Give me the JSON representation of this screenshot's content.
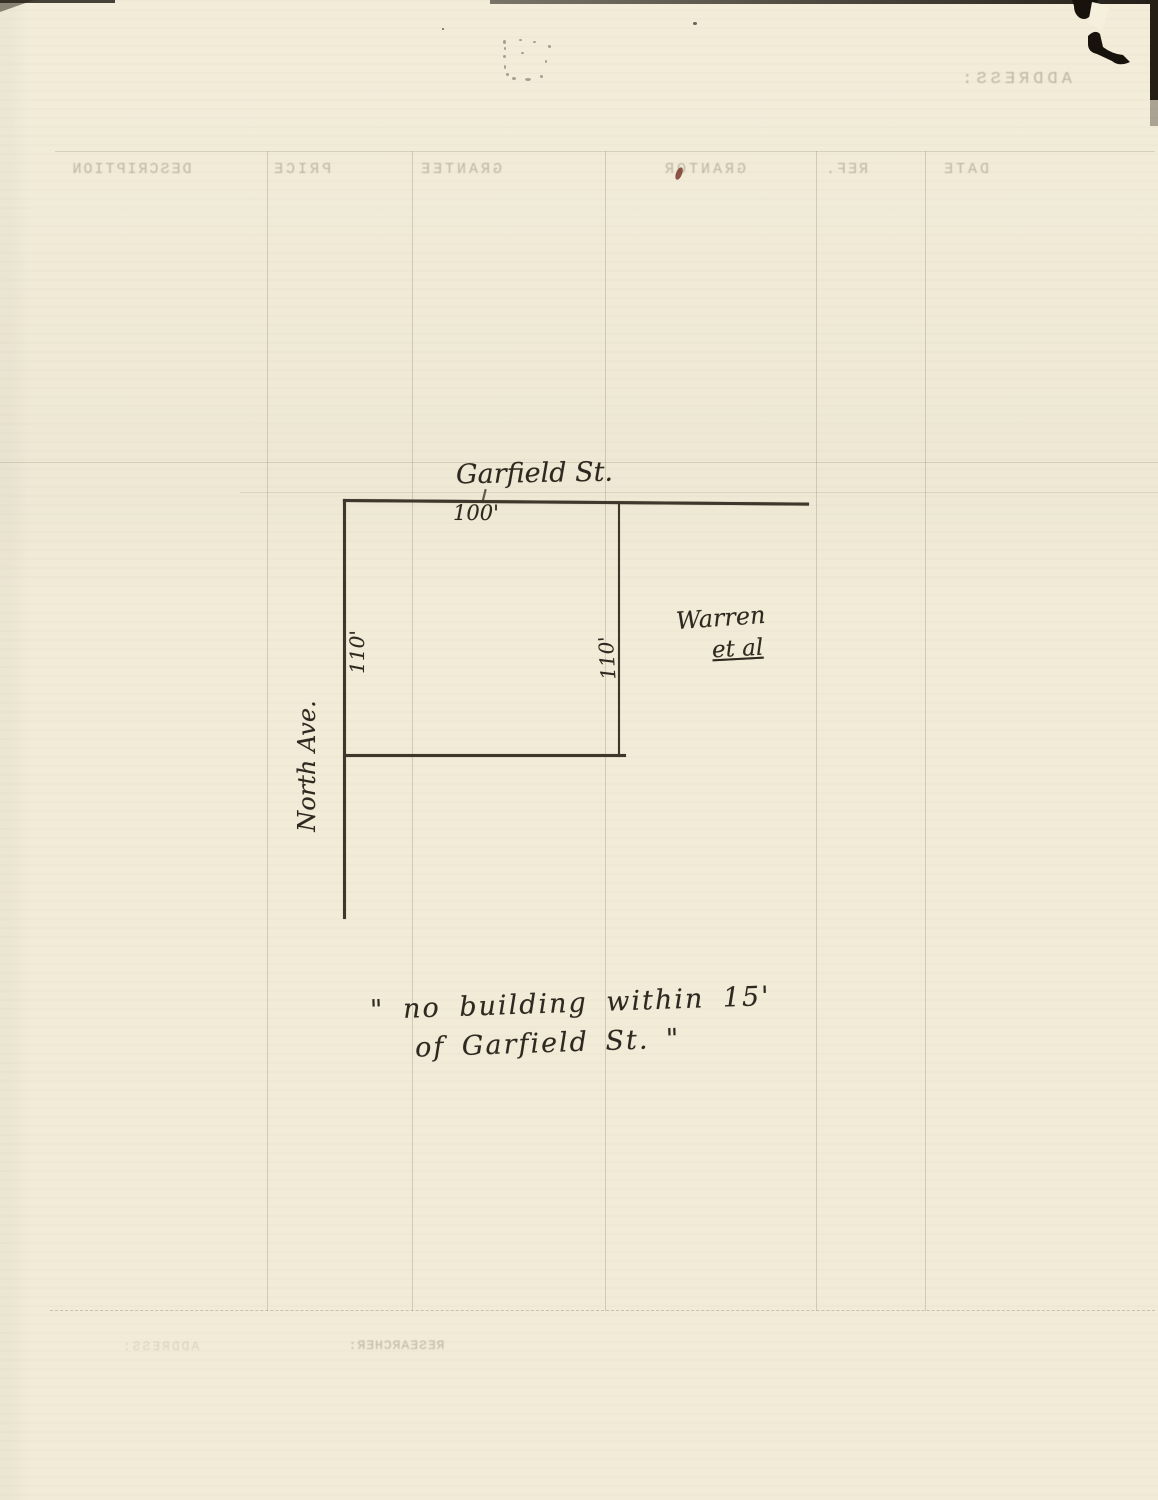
{
  "sketch": {
    "street_top_label": "Garfield St.",
    "street_left_label": "North Ave.",
    "top_width_label": "100'",
    "left_depth_label": "110'",
    "right_depth_label": "110'",
    "bottom_width_label": "100'",
    "owner_name": "Warren",
    "owner_suffix": "et al",
    "note_line1": "\" no building within  15'",
    "note_line2": "of Garfield St. \""
  },
  "ghost_bleedthrough": {
    "top_field_label": "ADDRESS:",
    "bottom_left_field_label": "ADDRESS:",
    "bottom_researcher_label": "RESEARCHER:",
    "table_headers": [
      "DESCRIPTION",
      "PRICE",
      "GRANTEE",
      "GRANTOR",
      "REF.",
      "DATE"
    ]
  },
  "colors": {
    "paper": "#f1ebd7",
    "ink": "#3f372b",
    "ghost_text": "#8a7c5f",
    "edge_artifact": "#18130d",
    "red_speck": "#7a3a2c"
  }
}
